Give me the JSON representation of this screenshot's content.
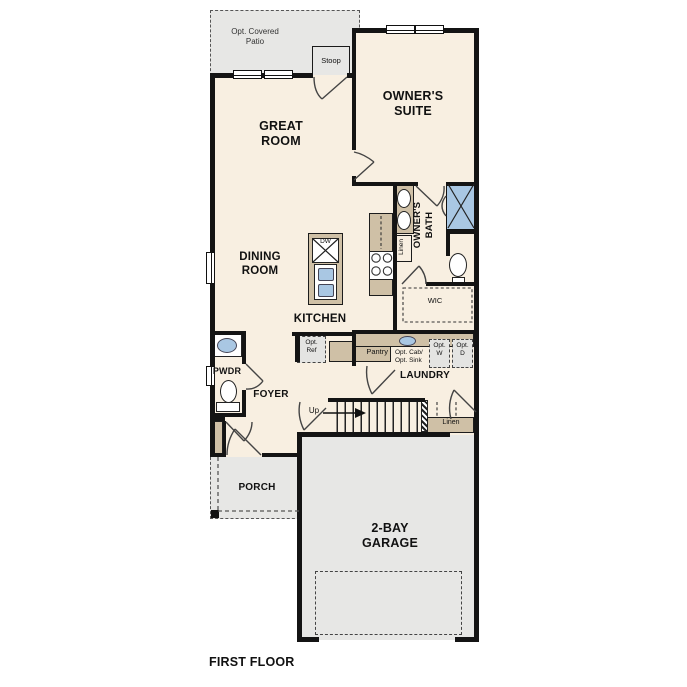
{
  "labels": {
    "patio": "Opt. Covered\nPatio",
    "stoop": "Stoop",
    "owners_suite": "OWNER'S\nSUITE",
    "great_room": "GREAT\nROOM",
    "dining_room": "DINING\nROOM",
    "kitchen": "KITCHEN",
    "owners_bath": "OWNER'S\nBATH",
    "bath_linen": "Linen",
    "wic": "WIC",
    "opt_ref": "Opt.\nRef",
    "pantry": "Pantry",
    "opt_cab_sink": "Opt. Cab/\nOpt. Sink",
    "opt_washer": "Opt.\nW",
    "opt_dryer": "Opt.\nD",
    "laundry": "LAUNDRY",
    "pwdr": "PWDR",
    "foyer": "FOYER",
    "up": "Up",
    "stairs_linen": "Linen",
    "porch": "PORCH",
    "garage": "2-BAY\nGARAGE",
    "dishwasher": "DW",
    "first_floor": "FIRST FLOOR"
  },
  "colors": {
    "floor_cream": "#f8efe1",
    "outdoor_gray": "#e7e7e5",
    "cabinet_tan": "#cfc0a6",
    "fixture_blue": "#a9c7e3",
    "wall_black": "#141414"
  }
}
